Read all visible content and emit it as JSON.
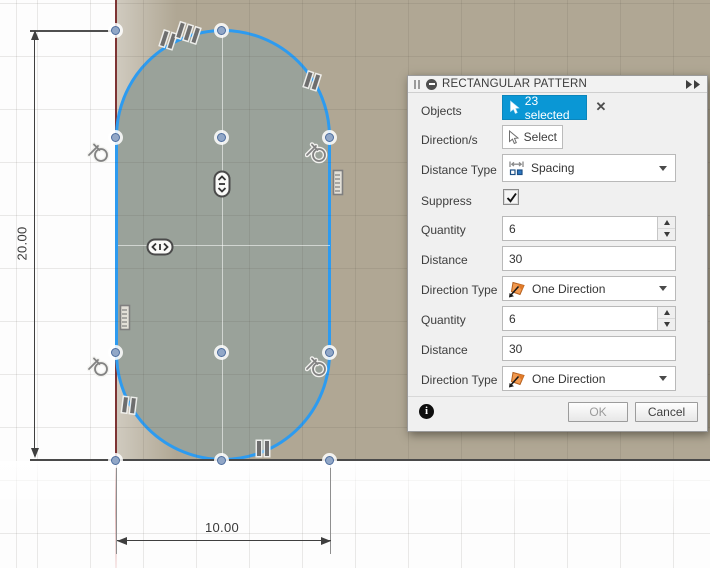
{
  "canvas": {
    "dimensions": {
      "height_label": "20.00",
      "width_label": "10.00"
    },
    "colors": {
      "selection_blue": "#2d9bf0",
      "accent_blue": "#0a97d5",
      "surface_tan": "#b0a794",
      "profile_fill": "#9aa29a",
      "axis_red": "#7e3434"
    },
    "icons": {
      "constraints": [
        "tangent-icon",
        "parallel-icon",
        "symmetry-vertical-icon",
        "symmetry-horizontal-icon",
        "collinear-icon"
      ]
    }
  },
  "dialog": {
    "title": "RECTANGULAR PATTERN",
    "header_icons": [
      "collapse-icon",
      "expand-icon",
      "drag-grip-icon"
    ],
    "rows": {
      "objects": {
        "label": "Objects",
        "button": "23 selected",
        "clear_icon": "✕"
      },
      "directions": {
        "label": "Direction/s",
        "button": "Select"
      },
      "distance_type": {
        "label": "Distance Type",
        "value": "Spacing"
      },
      "suppress": {
        "label": "Suppress",
        "checked": true
      },
      "quantity1": {
        "label": "Quantity",
        "value": "6"
      },
      "distance1": {
        "label": "Distance",
        "value": "30"
      },
      "direction_type1": {
        "label": "Direction Type",
        "value": "One Direction"
      },
      "quantity2": {
        "label": "Quantity",
        "value": "6"
      },
      "distance2": {
        "label": "Distance",
        "value": "30"
      },
      "direction_type2": {
        "label": "Direction Type",
        "value": "One Direction"
      }
    },
    "footer": {
      "ok": "OK",
      "cancel": "Cancel",
      "info_icon": "i"
    }
  }
}
